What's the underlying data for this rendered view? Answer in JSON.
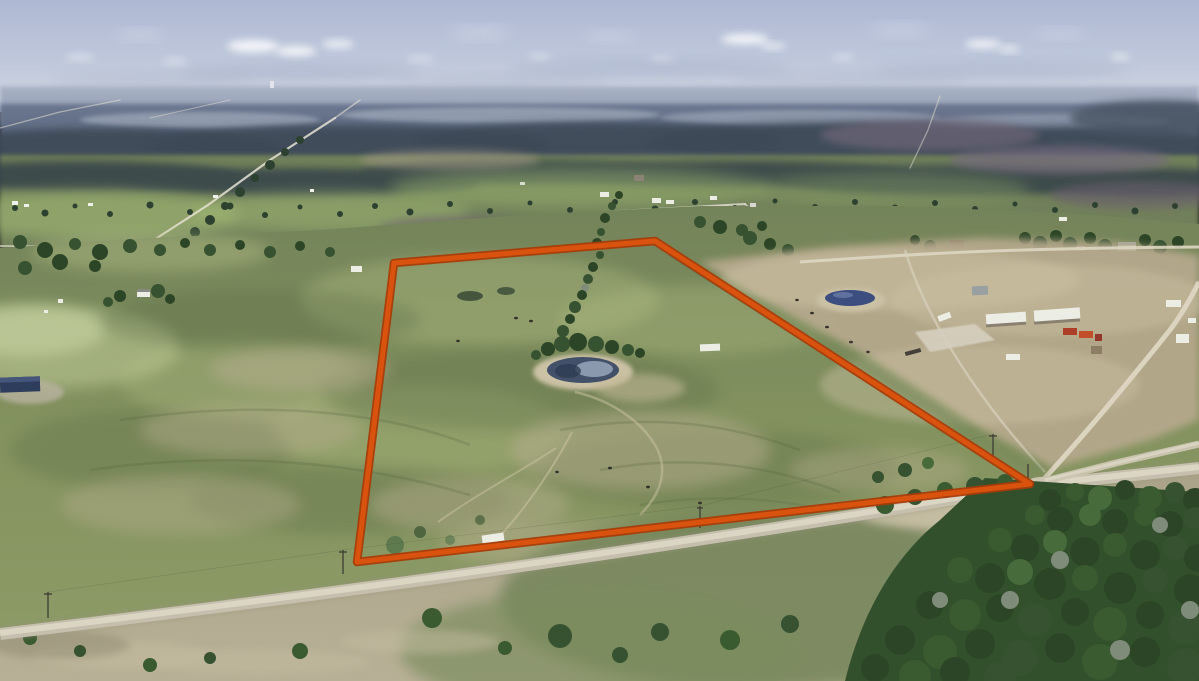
{
  "scene": {
    "type": "aerial-drone-photo",
    "subject": "rural ranch land parcel with highlighted property boundary, pond, country road and neighboring farm",
    "boundary": {
      "points": "394,263 655,241 1030,484 357,562",
      "outer_color": "#a83c08",
      "inner_color": "#d9530e"
    },
    "colors": {
      "sky_top": "#aeb8d3",
      "sky_horizon": "#d3d8e3",
      "haze": "#8e99b0",
      "distant_land": "#5f6b80",
      "tree_band": "#3d4a57",
      "pasture": "#7c8b5b",
      "pasture_light": "#b7c389",
      "bright_field": "#a3ba74",
      "plowed_field": "#6e6678",
      "dirt": "#b5a88c",
      "road": "#c6bfae",
      "road_light": "#ddd7c6",
      "grove_base": "#33502c",
      "tree_dark": "#2e4629",
      "tree_gray": "#7f8c7a",
      "pond_water": "#42506a",
      "pond_reflection": "#98a6ba",
      "pond_rim": "#cbc1a4",
      "farm_pond": "#3c4d80",
      "container_red": "#c14f2a"
    },
    "features": {
      "property_pond": {
        "cx": 583,
        "cy": 370,
        "rx": 36,
        "ry": 13
      },
      "farm_pond": {
        "cx": 850,
        "cy": 298,
        "rx": 25,
        "ry": 8
      }
    }
  }
}
